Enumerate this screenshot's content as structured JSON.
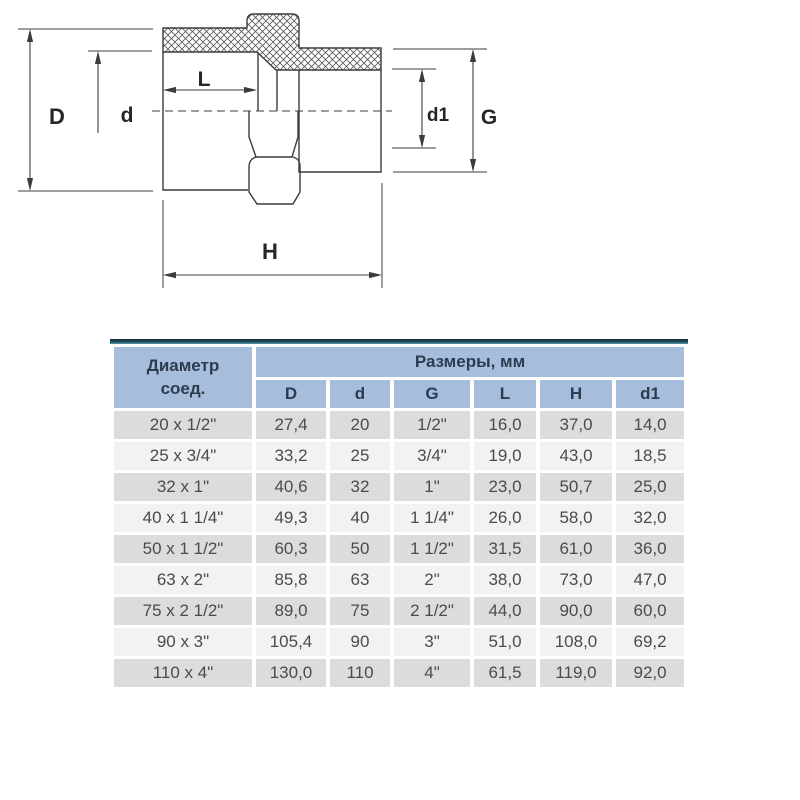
{
  "diagram": {
    "labels": {
      "D": "D",
      "d": "d",
      "L": "L",
      "d1": "d1",
      "G": "G",
      "H": "H"
    }
  },
  "table": {
    "header": {
      "col1_line1": "Диаметр",
      "col1_line2": "соед.",
      "group_title": "Размеры, мм",
      "columns": [
        "D",
        "d",
        "G",
        "L",
        "H",
        "d1"
      ]
    },
    "rows": [
      [
        "20 x 1/2\"",
        "27,4",
        "20",
        "1/2\"",
        "16,0",
        "37,0",
        "14,0"
      ],
      [
        "25 x 3/4\"",
        "33,2",
        "25",
        "3/4\"",
        "19,0",
        "43,0",
        "18,5"
      ],
      [
        "32 x 1\"",
        "40,6",
        "32",
        "1\"",
        "23,0",
        "50,7",
        "25,0"
      ],
      [
        "40 x 1 1/4\"",
        "49,3",
        "40",
        "1 1/4\"",
        "26,0",
        "58,0",
        "32,0"
      ],
      [
        "50 x 1 1/2\"",
        "60,3",
        "50",
        "1 1/2\"",
        "31,5",
        "61,0",
        "36,0"
      ],
      [
        "63 x 2\"",
        "85,8",
        "63",
        "2\"",
        "38,0",
        "73,0",
        "47,0"
      ],
      [
        "75 x 2 1/2\"",
        "89,0",
        "75",
        "2 1/2\"",
        "44,0",
        "90,0",
        "60,0"
      ],
      [
        "90 x 3\"",
        "105,4",
        "90",
        "3\"",
        "51,0",
        "108,0",
        "69,2"
      ],
      [
        "110 x 4\"",
        "130,0",
        "110",
        "4\"",
        "61,5",
        "119,0",
        "92,0"
      ]
    ]
  },
  "colors": {
    "header_bg": "#a6bddc",
    "row_gray": "#dcdcdc",
    "row_light": "#f2f2f2",
    "top_border_dark": "#143848",
    "top_border_teal": "#5b98a9",
    "drawing_line": "#3c3c3c"
  }
}
